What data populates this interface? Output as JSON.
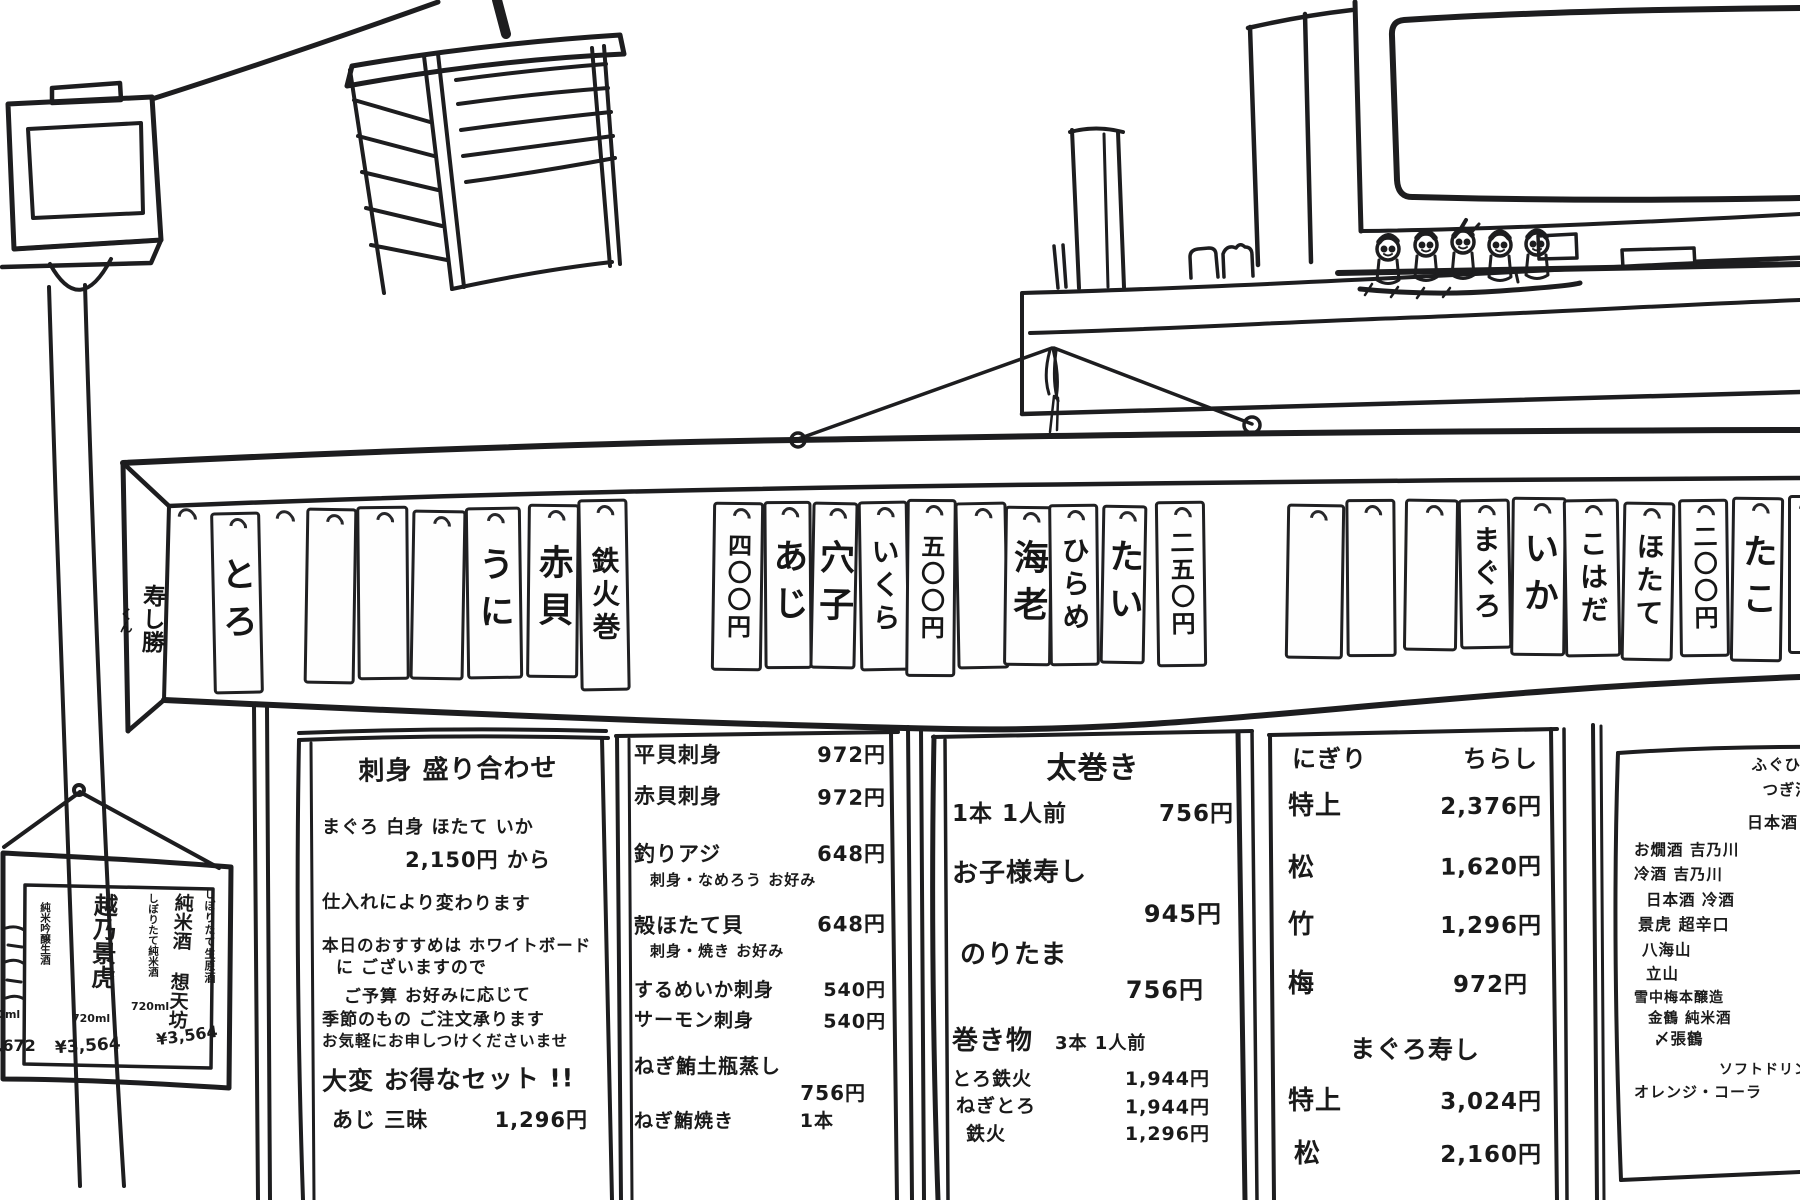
{
  "rail": {
    "shop_name": "寿し勝",
    "shop_name_suffix": "くん",
    "tags": [
      "とろ",
      "",
      "",
      "",
      "うに",
      "赤貝",
      "鉄火巻",
      "四〇〇円",
      "あじ",
      "穴子",
      "いくら",
      "五〇〇円",
      "",
      "海老",
      "ひらめ",
      "たい",
      "二五〇円",
      "",
      "",
      "",
      "まぐろ",
      "いか",
      "こはだ",
      "ほたて",
      "二〇〇円",
      "たこ",
      ""
    ]
  },
  "sake_sign": {
    "items": [
      {
        "header": "しぼりたて生原酒",
        "name": "純米酒 想天坊",
        "size": "720ml",
        "price": "¥3,564"
      },
      {
        "header": "しぼりたて純米酒",
        "name": "越乃景虎",
        "size": "720ml",
        "price": "¥3,564"
      },
      {
        "header": "純米吟醸生酒",
        "name": "",
        "size": "720ml",
        "price": "¥3,672"
      }
    ]
  },
  "boards": {
    "sashimi_set": {
      "title": "刺身 盛り合わせ",
      "desc": [
        "まぐろ 白身 ほたて いか",
        "2,150円 から",
        "仕入れにより変わります",
        "本日のおすすめは ホワイトボード",
        "に ございますので",
        "ご予算 お好みに応じて",
        "季節のもの ご注文承ります",
        "お気軽にお申しつけくださいませ"
      ],
      "promo": "大変 お得なセット !!",
      "set": {
        "n": "あじ 三昧",
        "p": "1,296円"
      }
    },
    "sashimi_items": {
      "rows": [
        {
          "n": "平貝刺身",
          "p": "972円"
        },
        {
          "n": "赤貝刺身",
          "p": "972円"
        },
        {
          "n": "釣りアジ",
          "p": "648円"
        },
        {
          "n": "殻ほたて貝",
          "p": "648円"
        },
        {
          "n": "するめいか刺身",
          "p": "540円"
        },
        {
          "n": "サーモン刺身",
          "p": "540円"
        },
        {
          "n": "ねぎ鮪土瓶蒸し",
          "p": "756円"
        },
        {
          "n": "ねぎ鮪焼き",
          "p": "1本"
        }
      ],
      "notes": [
        "刺身・なめろう お好み",
        "刺身・焼き お好み"
      ]
    },
    "rolls": {
      "title": "太巻き",
      "futomaki": {
        "n": "1本 1人前",
        "p": "756円"
      },
      "items": [
        {
          "n": "お子様寿し",
          "p": "945円"
        },
        {
          "n": "のりたま",
          "p": "756円"
        }
      ],
      "makimono": {
        "title": "巻き物",
        "note": "3本 1人前"
      },
      "rows": [
        {
          "n": "とろ鉄火",
          "p": "1,944円"
        },
        {
          "n": "ねぎとろ",
          "p": "1,944円"
        },
        {
          "n": "鉄火",
          "p": "1,296円"
        }
      ]
    },
    "nigiri": {
      "headers": [
        "にぎり",
        "ちらし"
      ],
      "rows": [
        {
          "n": "特上",
          "p": "2,376円"
        },
        {
          "n": "松",
          "p": "1,620円"
        },
        {
          "n": "竹",
          "p": "1,296円"
        },
        {
          "n": "梅",
          "p": "972円"
        }
      ],
      "maguro_title": "まぐろ寿し",
      "maguro_rows": [
        {
          "n": "特上",
          "p": "3,024円"
        },
        {
          "n": "松",
          "p": "2,160円"
        }
      ]
    },
    "drinks": {
      "lines": [
        "ふぐひれ酒",
        "つぎ酒",
        "日本酒",
        "お燗酒 吉乃川",
        "冷酒 吉乃川",
        "日本酒 冷酒",
        "景虎 超辛口",
        "八海山",
        "立山",
        "雪中梅本醸造",
        "金鶴 純米酒",
        "〆張鶴",
        "ソフトドリンク",
        "オレンジ・コーラ"
      ]
    }
  },
  "colors": {
    "ink": "#1d1d1f",
    "paper": "#ffffff"
  }
}
